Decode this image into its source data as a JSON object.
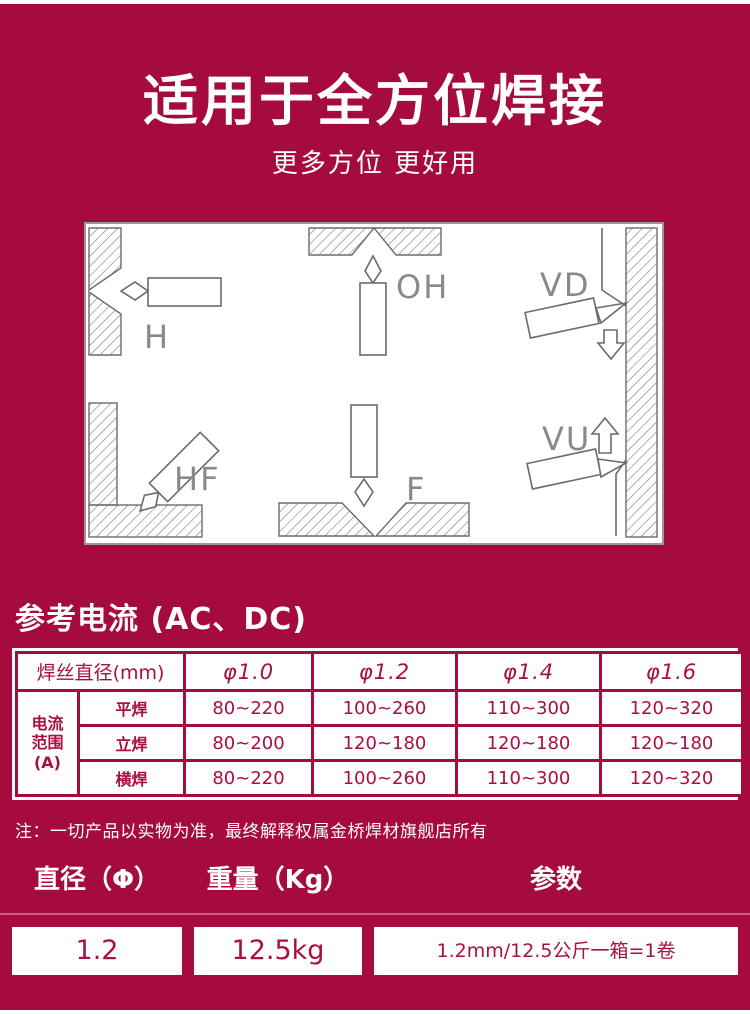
{
  "theme": {
    "background_maroon": "#A50B3C",
    "text_white": "#ffffff",
    "table_text_maroon": "#A80F42",
    "diagram_line_gray": "#6b6b6b"
  },
  "hero": {
    "title": "适用于全方位焊接",
    "subtitle": "更多方位 更好用"
  },
  "diagram": {
    "labels": {
      "h": "H",
      "oh": "OH",
      "vd": "VD",
      "hf": "HF",
      "f": "F",
      "vu": "VU"
    }
  },
  "current": {
    "heading": "参考电流 (AC、DC)",
    "table": {
      "diameter_header": "焊丝直径(mm)",
      "diameters": [
        "φ1.0",
        "φ1.2",
        "φ1.4",
        "φ1.6"
      ],
      "range_lines": [
        "电流",
        "范围",
        "(A)"
      ],
      "rows": [
        {
          "label": "平焊",
          "values": [
            "80~220",
            "100~260",
            "110~300",
            "120~320"
          ]
        },
        {
          "label": "立焊",
          "values": [
            "80~200",
            "120~180",
            "120~180",
            "120~180"
          ]
        },
        {
          "label": "横焊",
          "values": [
            "80~220",
            "100~260",
            "110~300",
            "120~320"
          ]
        }
      ]
    },
    "note": "注：一切产品以实物为准，最终解释权属金桥焊材旗舰店所有"
  },
  "specs": {
    "headers": [
      "直径（Φ）",
      "重量（Kg）",
      "参数"
    ],
    "values": [
      "1.2",
      "12.5kg",
      "1.2mm/12.5公斤一箱=1卷"
    ]
  }
}
